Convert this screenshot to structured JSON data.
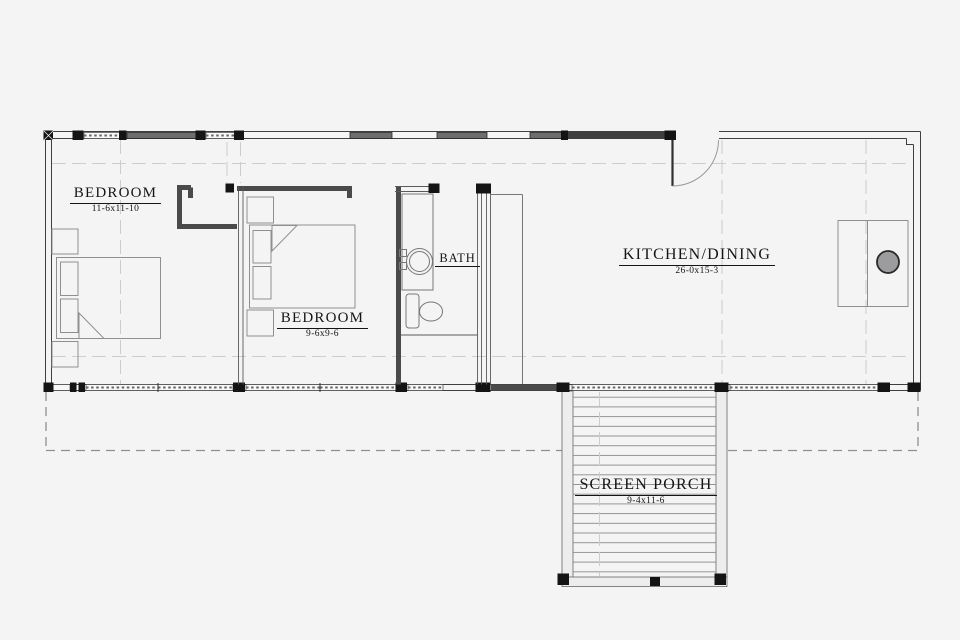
{
  "rooms": [
    {
      "id": "bedroom-1",
      "name": "BEDROOM",
      "dims": "11-6x11-10"
    },
    {
      "id": "bedroom-2",
      "name": "BEDROOM",
      "dims": "9-6x9-6"
    },
    {
      "id": "bath",
      "name": "BATH",
      "dims": ""
    },
    {
      "id": "kitchen-dining",
      "name": "KITCHEN/DINING",
      "dims": "26-0x15-3"
    },
    {
      "id": "screen-porch",
      "name": "SCREEN PORCH",
      "dims": "9-4x11-6"
    }
  ],
  "colors": {
    "background": "#f4f4f5",
    "wall_line": "#3f3f3f",
    "window_band_dark": "#6e6e6e",
    "post_black": "#141414",
    "furniture_line": "#8f8f8f",
    "decking_line": "#8a8a8a",
    "centerline": "#cdcdd1",
    "sink_fill": "#9c9c9e",
    "text": "#151515"
  }
}
